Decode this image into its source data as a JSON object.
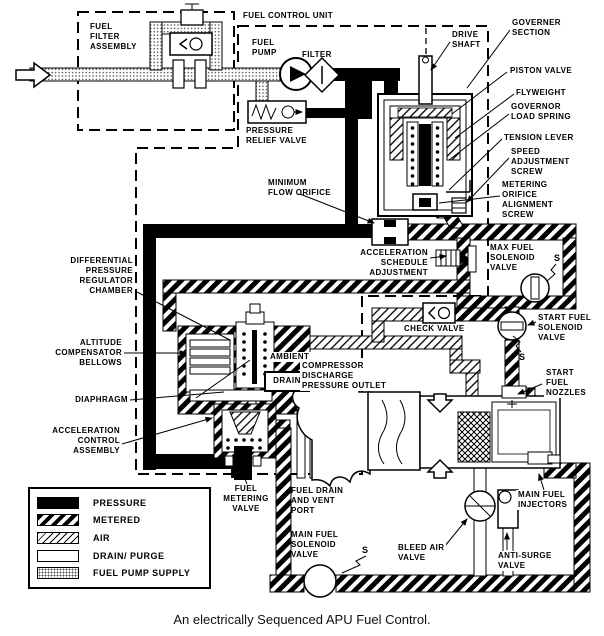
{
  "caption": "An electrically Sequenced APU Fuel Control.",
  "labels": {
    "fuel_filter_assembly": "FUEL\nFILTER\nASSEMBLY",
    "fuel_control_unit": "FUEL CONTROL UNIT",
    "fuel_pump": "FUEL\nPUMP",
    "filter": "FILTER",
    "pressure_relief_valve": "PRESSURE\nRELIEF VALVE",
    "drive_shaft": "DRIVE\nSHAFT",
    "governer_section": "GOVERNER\nSECTION",
    "piston_valve": "PISTON VALVE",
    "flyweight": "FLYWEIGHT",
    "governor_load_spring": "GOVERNOR\nLOAD SPRING",
    "tension_lever": "TENSION LEVER",
    "speed_adjustment_screw": "SPEED\nADJUSTMENT\nSCREW",
    "metering_orifice_alignment_screw": "METERING\nORIFICE\nALIGNMENT\nSCREW",
    "minimum_flow_orifice": "MINIMUM\nFLOW ORIFICE",
    "acceleration_schedule_adjustment": "ACCELERATION\nSCHEDULE\nADJUSTMENT",
    "max_fuel_solenoid_valve": "MAX FUEL\nSOLENOID\nVALVE",
    "differential_pressure_regulator_chamber": "DIFFERENTIAL\nPRESSURE\nREGULATOR\nCHAMBER",
    "check_valve": "CHECK VALVE",
    "start_fuel_solenoid_valve": "START FUEL\nSOLENOID\nVALVE",
    "altitude_compensator_bellows": "ALTITUDE\nCOMPENSATOR\nBELLOWS",
    "ambient": "AMBIENT",
    "drain": "DRAIN",
    "compressor_discharge_pressure_outlet": "COMPRESSOR\nDISCHARGE\nPRESSURE OUTLET",
    "diaphragm": "DIAPHRAGM",
    "start_fuel_nozzles": "START\nFUEL\nNOZZLES",
    "acceleration_control_assembly": "ACCELERATION\nCONTROL\nASSEMBLY",
    "fuel_metering_valve": "FUEL\nMETERING\nVALVE",
    "fuel_drain_and_vent_port": "FUEL DRAIN\nAND VENT\nPORT",
    "main_fuel_solenoid_valve": "MAIN FUEL\nSOLENOID\nVALVE",
    "bleed_air_valve": "BLEED AIR\nVALVE",
    "anti_surge_valve": "ANTI-SURGE\nVALVE",
    "main_fuel_injectors": "MAIN FUEL\nINJECTORS",
    "s_max": "S",
    "s_start": "S",
    "s_main": "S"
  },
  "legend": {
    "items": [
      {
        "label": "PRESSURE",
        "pattern": "pressure"
      },
      {
        "label": "METERED",
        "pattern": "metered"
      },
      {
        "label": "AIR",
        "pattern": "air"
      },
      {
        "label": "DRAIN/ PURGE",
        "pattern": "drain"
      },
      {
        "label": "FUEL PUMP SUPPLY",
        "pattern": "supply"
      }
    ]
  },
  "colors": {
    "ink": "#000000",
    "paper": "#ffffff"
  }
}
